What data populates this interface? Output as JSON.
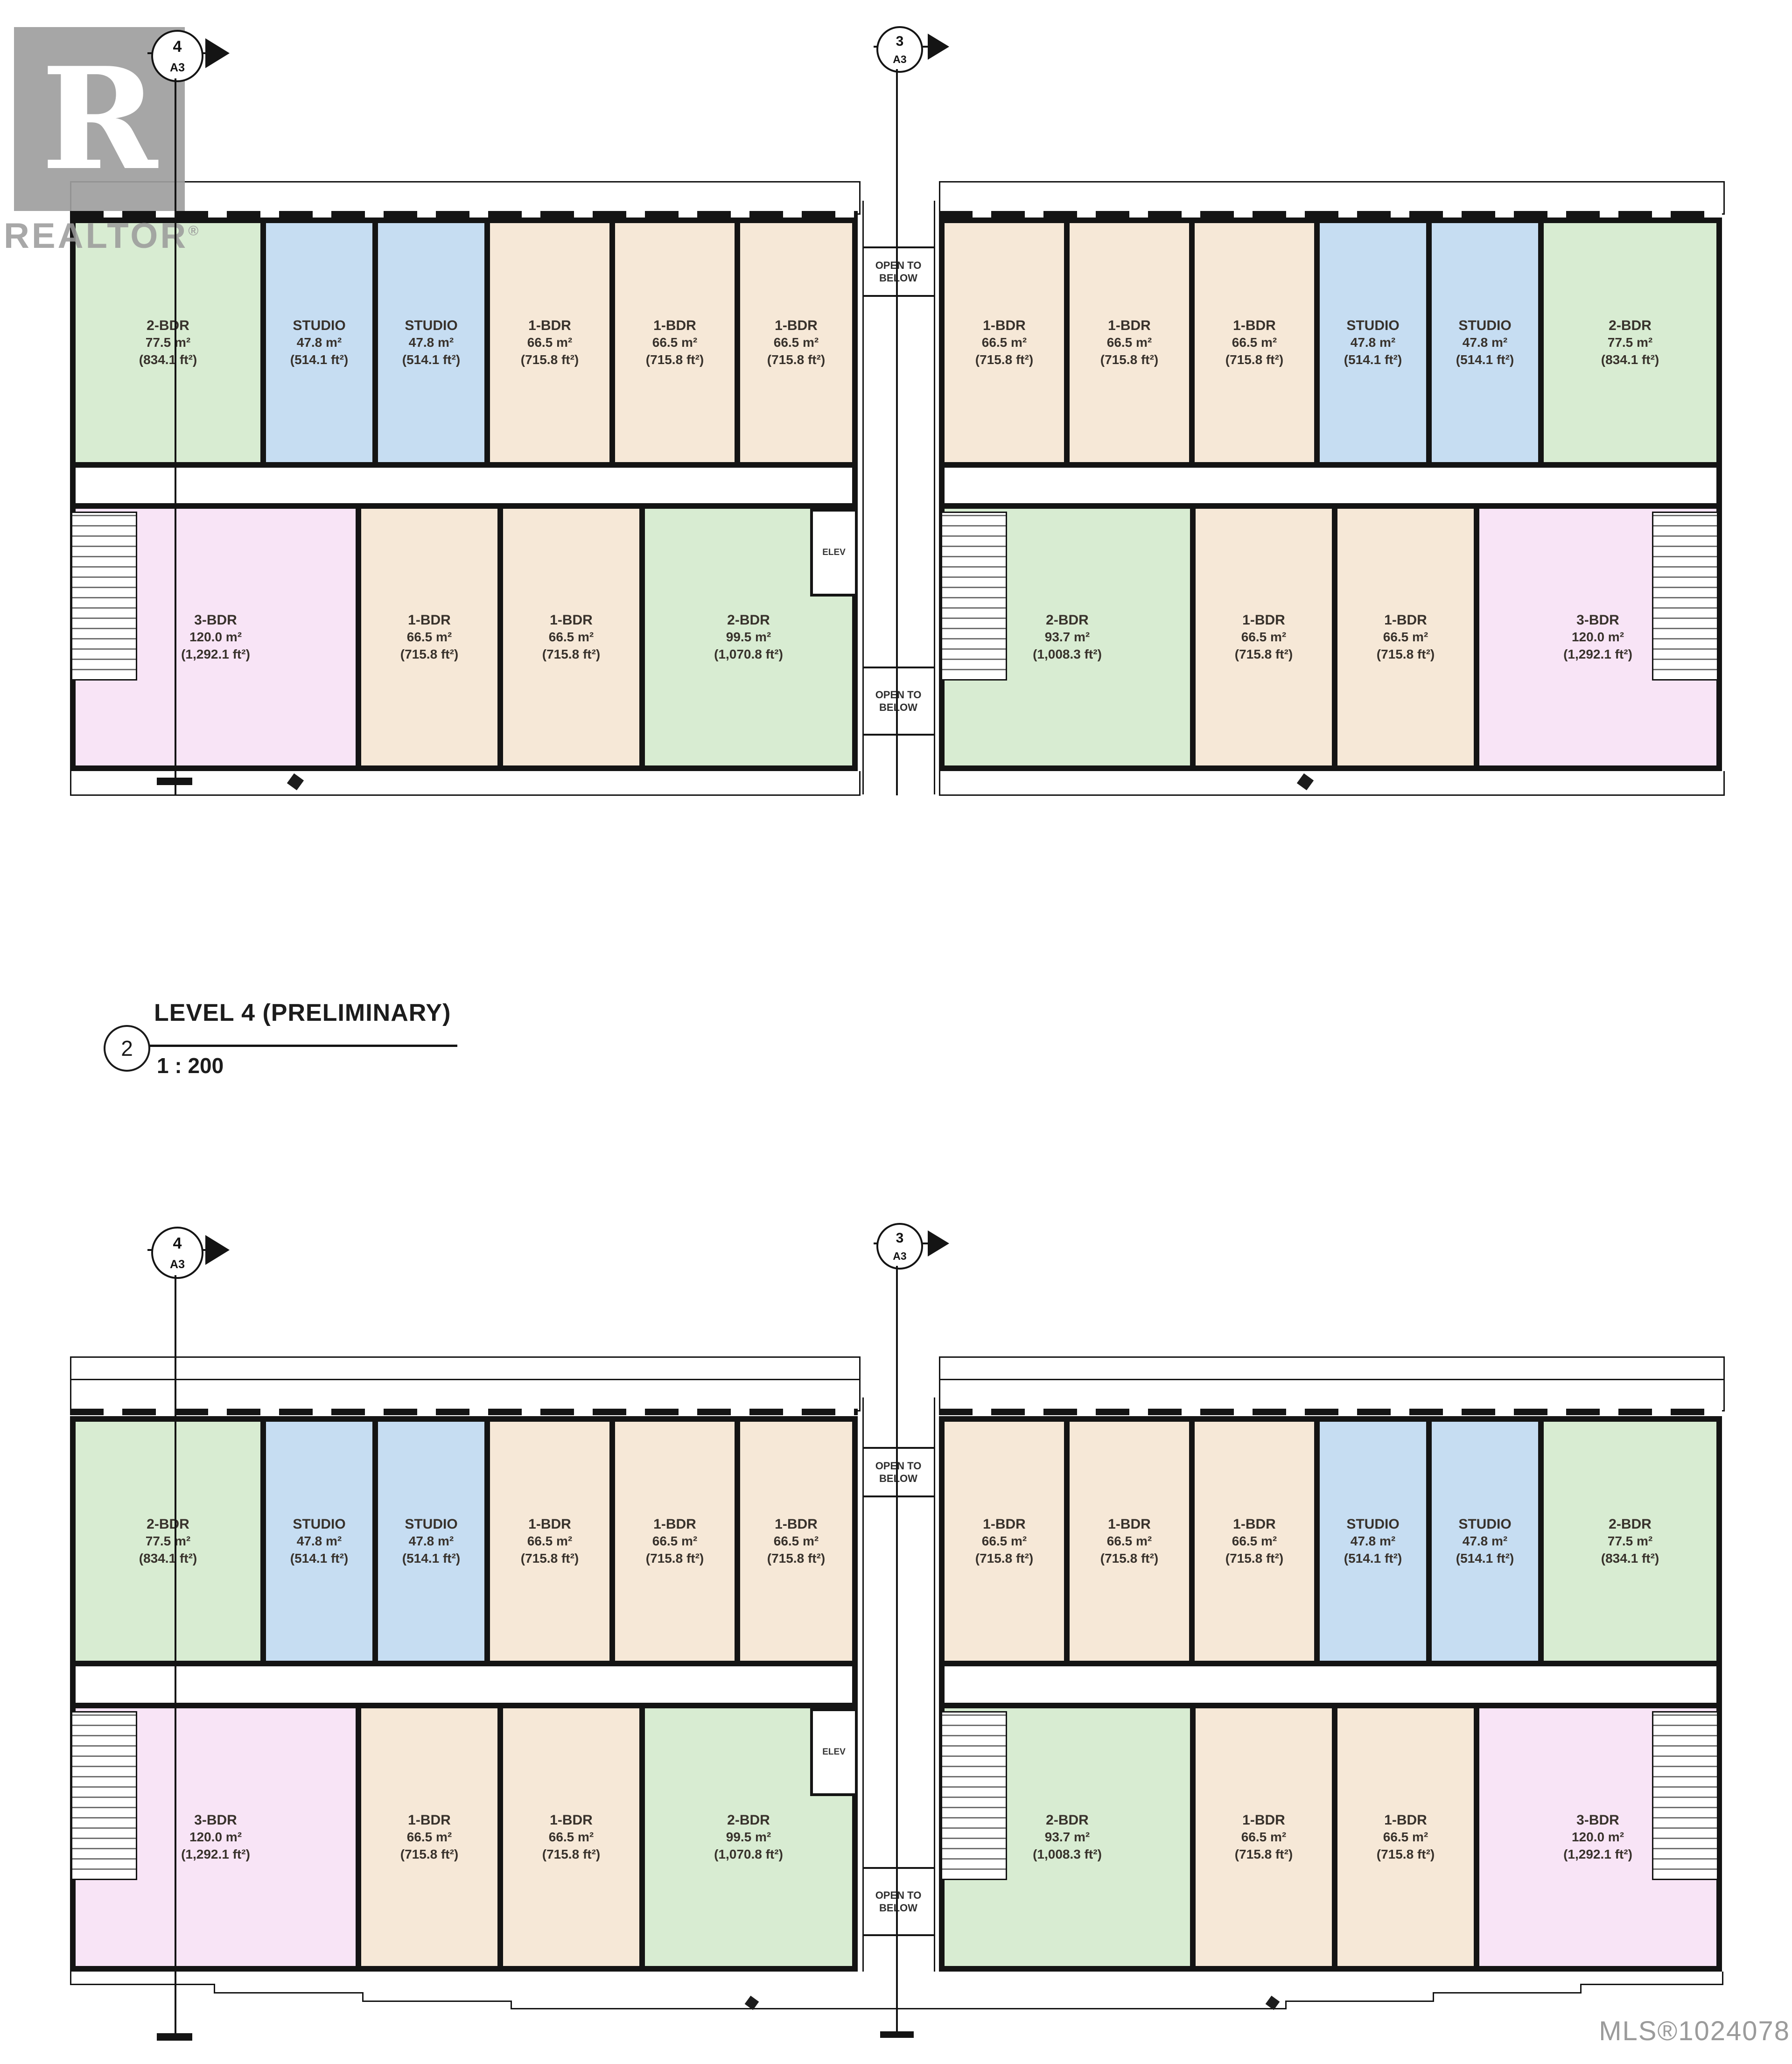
{
  "watermark": {
    "letter": "R",
    "word": "REALTOR",
    "reg": "®"
  },
  "title_block": {
    "number": "2",
    "title": "LEVEL 4 (PRELIMINARY)",
    "scale": "1 : 200"
  },
  "markers": {
    "left": {
      "num": "4",
      "sheet": "A3"
    },
    "center": {
      "num": "3",
      "sheet": "A3"
    }
  },
  "labels": {
    "open_line1": "OPEN TO",
    "open_line2": "BELOW",
    "elev": "ELEV"
  },
  "footer": {
    "mls": "MLS®1024078"
  },
  "colors": {
    "unit_green": "#d8ecd2",
    "unit_blue": "#c6ddf2",
    "unit_beige": "#f6e8d7",
    "unit_pink": "#f8e4f6",
    "wall": "#141414",
    "logo_gray": "#9a9a9a",
    "mls_gray": "#9b9b9b"
  },
  "left_building": {
    "upper": [
      {
        "type": "2-BDR",
        "m2": "77.5 m²",
        "ft2": "(834.1 ft²)"
      },
      {
        "type": "STUDIO",
        "m2": "47.8 m²",
        "ft2": "(514.1 ft²)"
      },
      {
        "type": "STUDIO",
        "m2": "47.8 m²",
        "ft2": "(514.1 ft²)"
      },
      {
        "type": "1-BDR",
        "m2": "66.5 m²",
        "ft2": "(715.8 ft²)"
      },
      {
        "type": "1-BDR",
        "m2": "66.5 m²",
        "ft2": "(715.8 ft²)"
      },
      {
        "type": "1-BDR",
        "m2": "66.5 m²",
        "ft2": "(715.8 ft²)"
      }
    ],
    "lower": [
      {
        "type": "3-BDR",
        "m2": "120.0 m²",
        "ft2": "(1,292.1 ft²)"
      },
      {
        "type": "1-BDR",
        "m2": "66.5 m²",
        "ft2": "(715.8 ft²)"
      },
      {
        "type": "1-BDR",
        "m2": "66.5 m²",
        "ft2": "(715.8 ft²)"
      },
      {
        "type": "2-BDR",
        "m2": "99.5 m²",
        "ft2": "(1,070.8 ft²)"
      }
    ]
  },
  "right_building": {
    "upper": [
      {
        "type": "1-BDR",
        "m2": "66.5 m²",
        "ft2": "(715.8 ft²)"
      },
      {
        "type": "1-BDR",
        "m2": "66.5 m²",
        "ft2": "(715.8 ft²)"
      },
      {
        "type": "1-BDR",
        "m2": "66.5 m²",
        "ft2": "(715.8 ft²)"
      },
      {
        "type": "STUDIO",
        "m2": "47.8 m²",
        "ft2": "(514.1 ft²)"
      },
      {
        "type": "STUDIO",
        "m2": "47.8 m²",
        "ft2": "(514.1 ft²)"
      },
      {
        "type": "2-BDR",
        "m2": "77.5 m²",
        "ft2": "(834.1 ft²)"
      }
    ],
    "lower": [
      {
        "type": "2-BDR",
        "m2": "93.7 m²",
        "ft2": "(1,008.3 ft²)"
      },
      {
        "type": "1-BDR",
        "m2": "66.5 m²",
        "ft2": "(715.8 ft²)"
      },
      {
        "type": "1-BDR",
        "m2": "66.5 m²",
        "ft2": "(715.8 ft²)"
      },
      {
        "type": "3-BDR",
        "m2": "120.0 m²",
        "ft2": "(1,292.1 ft²)"
      }
    ]
  }
}
